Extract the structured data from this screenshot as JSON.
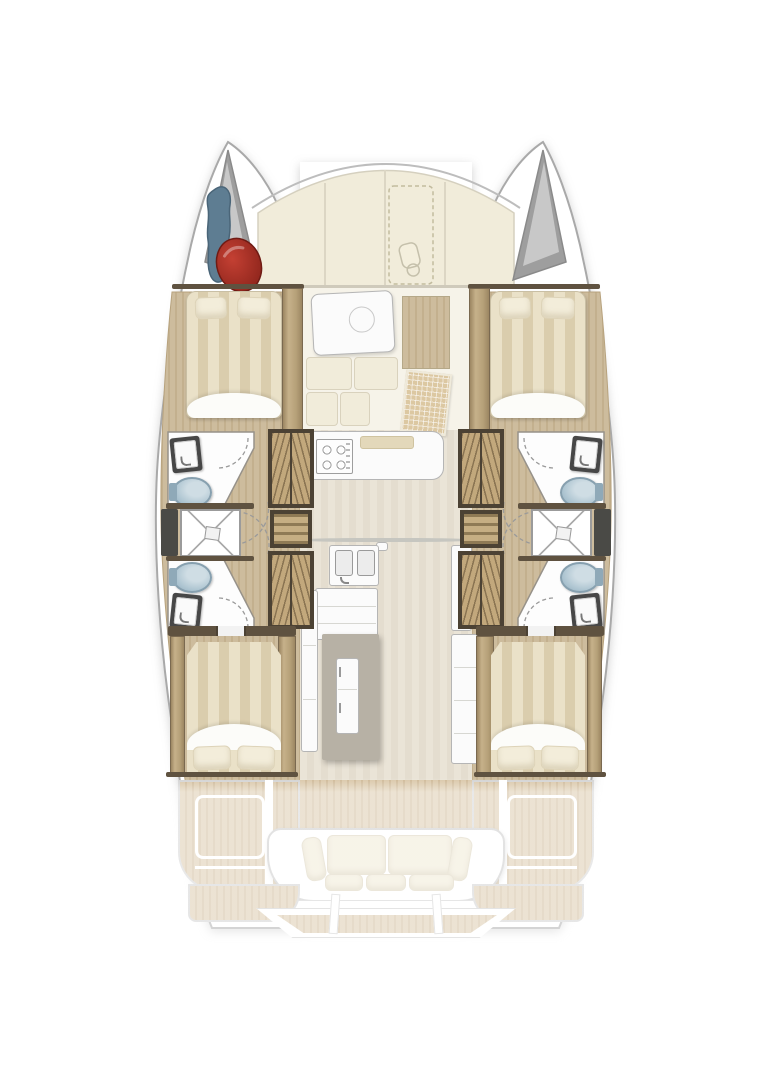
{
  "page": {
    "background": "#ffffff"
  },
  "colors": {
    "hull_outline": "#a9a9a9",
    "deck_cream": "#f1ecda",
    "panel_line": "#dcd6c4",
    "wood_light": "#cdbc9d",
    "wood_light2": "#c3b08e",
    "wood_dark_frame": "#4c4234",
    "chevron_tan": "#c2a87c",
    "chevron_dark": "#8a7452",
    "mattress_light": "#eae1c8",
    "mattress_dark": "#dacdad",
    "pillow": "#f3edda",
    "fixture_white": "#fbfbfb",
    "fixture_border": "#b5b5b5",
    "toilet_blue": "#aac2cf",
    "toilet_blue_dark": "#8fa9b8",
    "sink_frame": "#474747",
    "shower_line": "#9b9b9b",
    "window_dark": "#4a4a46",
    "locker_gray": "#9e9e9e",
    "locker_gray_light": "#c8c8c8",
    "fender_red": "#c44033",
    "fender_red_dark": "#8c241b",
    "gear_blue": "#5e7d92",
    "gear_blue_dark": "#4a6578",
    "teak": "#d9c6a7",
    "teak_dark": "#cdb795",
    "island_gray": "#b7b1a5",
    "cushion_grid": "#dcc8a2",
    "bulkhead_dark": "#5f5240"
  },
  "plan": {
    "vessel": "catamaran",
    "view": "overhead-deck-plan",
    "symmetry": "port-starboard-mirrored",
    "regions": [
      "foredeck",
      "port-bow-locker",
      "starboard-bow-locker",
      "port-forward-cabin",
      "starboard-forward-cabin",
      "port-forward-head",
      "starboard-forward-head",
      "port-shower",
      "starboard-shower",
      "port-aft-head",
      "starboard-aft-head",
      "salon-dinette",
      "galley",
      "port-aft-cabin",
      "starboard-aft-cabin",
      "aft-cockpit",
      "swim-platform"
    ],
    "counts": {
      "cabins": 4,
      "beds": 4,
      "heads": 4,
      "toilets": 4,
      "sinks": 6,
      "showers": 2
    }
  }
}
